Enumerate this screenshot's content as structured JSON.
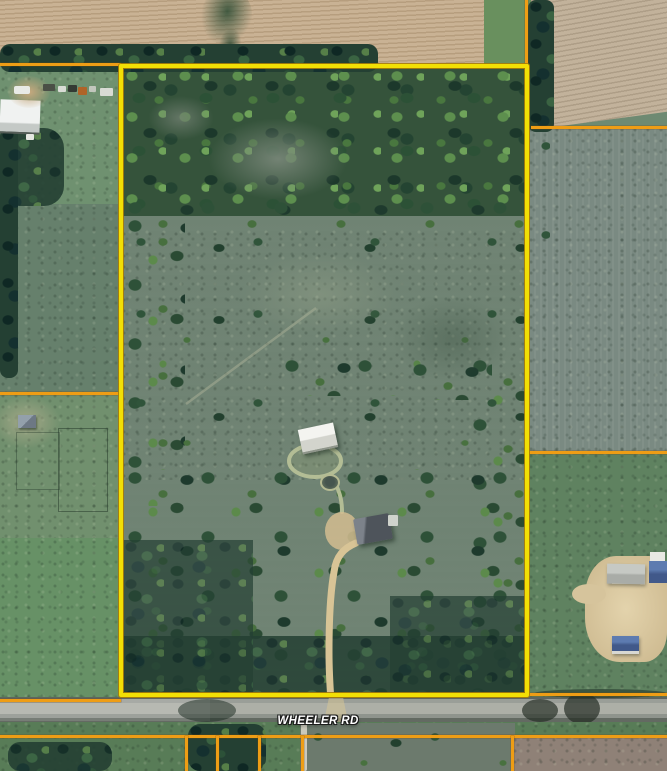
{
  "map": {
    "view": "aerial-satellite-parcel-view",
    "road": {
      "label": "WHEELER RD"
    },
    "colors": {
      "parcel_boundary": "#f2df05",
      "parcel_boundary_edge": "#a97d08",
      "cadastral_line": "#ee9d15",
      "road_surface": "#a7aaa4",
      "road_label_text": "#ffffff",
      "driveway": "#d8c496",
      "forest": "#35533b",
      "meadow": "#7a8b7d",
      "plowed_field": "#c9b294"
    },
    "features": [
      {
        "name": "highlighted-parcel"
      },
      {
        "name": "wheeler-road"
      },
      {
        "name": "forest-band"
      },
      {
        "name": "meadow"
      },
      {
        "name": "barn"
      },
      {
        "name": "house"
      },
      {
        "name": "pond"
      },
      {
        "name": "driveway"
      },
      {
        "name": "neighbor-farmstead"
      },
      {
        "name": "plowed-fields"
      }
    ]
  }
}
